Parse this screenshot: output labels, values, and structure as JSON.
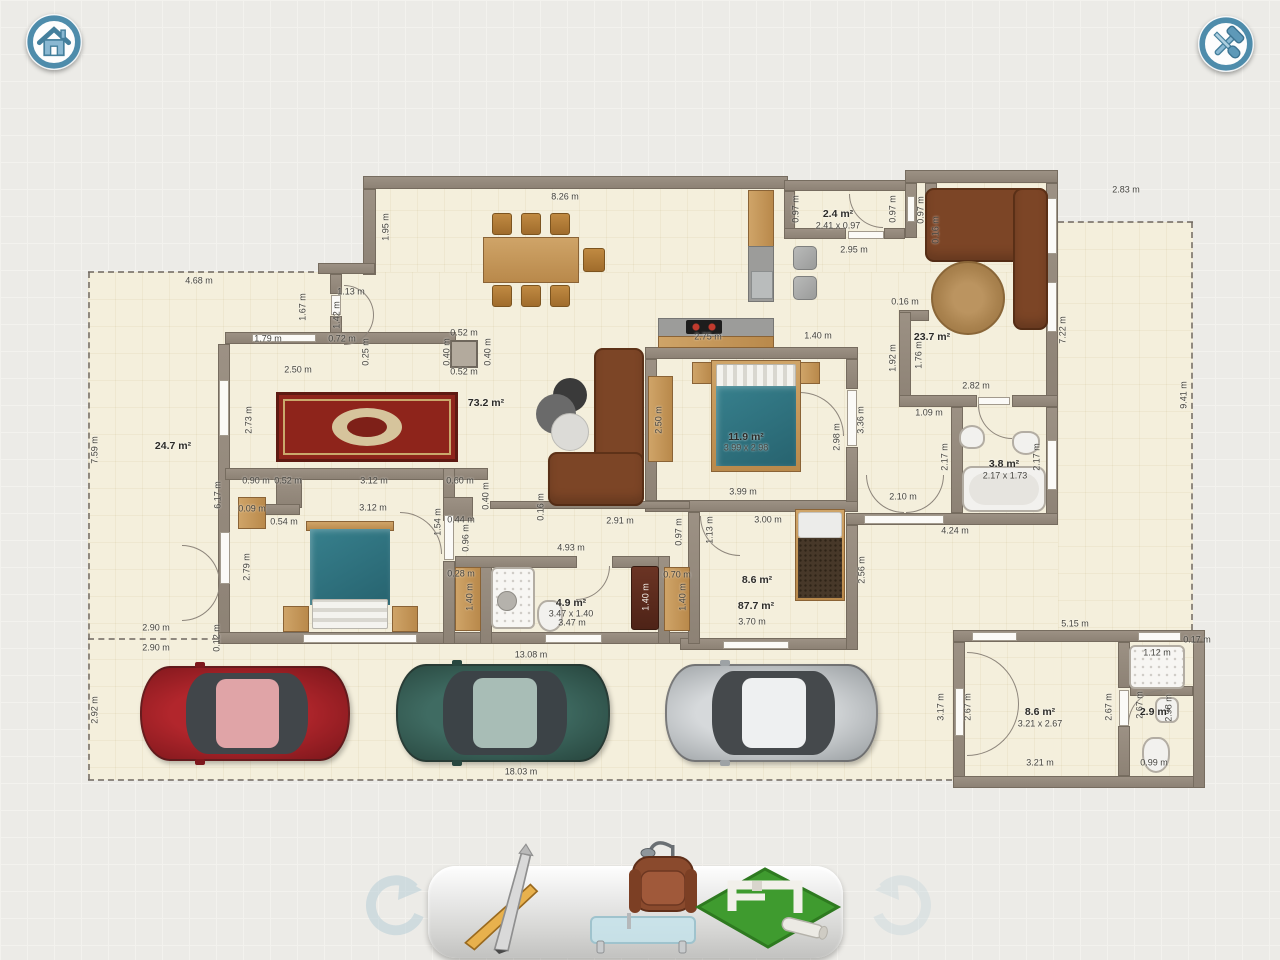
{
  "app": {
    "name": "floor-plan-editor",
    "view": "2d-plan"
  },
  "header": {
    "home_button": {
      "icon": "home-icon"
    },
    "tools_button": {
      "icon": "hammer-screwdriver-icon"
    }
  },
  "tray": {
    "undo_icon": "undo-arrow-icon",
    "redo_icon": "redo-arrow-icon",
    "tools": [
      {
        "name": "draw-tool",
        "icon": "pencil-ruler-icon"
      },
      {
        "name": "furnish-tool",
        "icon": "armchair-lamp-table-icon"
      },
      {
        "name": "build-tool",
        "icon": "house-model-grass-icon"
      }
    ]
  },
  "colors": {
    "accent_blue": "#4e8cab",
    "wall": "#948a7d",
    "floor": "#f4efdc",
    "bed_teal": "#2f7582",
    "rug_red": "#8e241b",
    "sofa_brown": "#7c4526",
    "car_red": "#b2262c",
    "car_teal": "#3f6b62",
    "car_silver": "#d2d5d7",
    "grass_green": "#3f9b2f"
  },
  "plan": {
    "unit": "m",
    "labels": [
      {
        "t": "8.26 m",
        "x": 565,
        "y": 197
      },
      {
        "t": "1.95 m",
        "x": 386,
        "y": 227,
        "r": 1
      },
      {
        "t": "2.83 m",
        "x": 1126,
        "y": 190
      },
      {
        "t": "7.22 m",
        "x": 1063,
        "y": 330,
        "r": 1
      },
      {
        "t": "9.41 m",
        "x": 1184,
        "y": 395,
        "r": 1
      },
      {
        "t": "4.68 m",
        "x": 199,
        "y": 281
      },
      {
        "t": "1.13 m",
        "x": 351,
        "y": 292
      },
      {
        "t": "1.67 m",
        "x": 303,
        "y": 307,
        "r": 1
      },
      {
        "t": "1.42 m",
        "x": 337,
        "y": 315,
        "r": 1
      },
      {
        "t": "1.79 m",
        "x": 268,
        "y": 339
      },
      {
        "t": "0.72 m",
        "x": 342,
        "y": 339
      },
      {
        "t": "0.25 m",
        "x": 366,
        "y": 352,
        "r": 1
      },
      {
        "t": "2.50 m",
        "x": 298,
        "y": 370
      },
      {
        "t": "0.52 m",
        "x": 464,
        "y": 333
      },
      {
        "t": "0.40 m",
        "x": 447,
        "y": 352,
        "r": 1
      },
      {
        "t": "0.40 m",
        "x": 488,
        "y": 352,
        "r": 1
      },
      {
        "t": "0.52 m",
        "x": 464,
        "y": 372
      },
      {
        "t": "73.2 m²",
        "x": 486,
        "y": 403,
        "b": 1
      },
      {
        "t": "24.7 m²",
        "x": 173,
        "y": 446,
        "b": 1
      },
      {
        "t": "7.59 m",
        "x": 95,
        "y": 450,
        "r": 1
      },
      {
        "t": "2.73 m",
        "x": 249,
        "y": 420,
        "r": 1
      },
      {
        "t": "2.4 m²",
        "x": 838,
        "y": 214,
        "b": 1
      },
      {
        "t": "2.41 x 0.97",
        "x": 838,
        "y": 226
      },
      {
        "t": "0.97 m",
        "x": 796,
        "y": 209,
        "r": 1
      },
      {
        "t": "0.97 m",
        "x": 893,
        "y": 209,
        "r": 1
      },
      {
        "t": "0.97 m",
        "x": 921,
        "y": 210,
        "r": 1
      },
      {
        "t": "0.16 m",
        "x": 936,
        "y": 230,
        "r": 1
      },
      {
        "t": "2.95 m",
        "x": 854,
        "y": 250
      },
      {
        "t": "2.75 m",
        "x": 708,
        "y": 337
      },
      {
        "t": "1.40 m",
        "x": 818,
        "y": 336
      },
      {
        "t": "0.16 m",
        "x": 905,
        "y": 302
      },
      {
        "t": "23.7 m²",
        "x": 932,
        "y": 337,
        "b": 1
      },
      {
        "t": "1.92 m",
        "x": 893,
        "y": 358,
        "r": 1
      },
      {
        "t": "1.76 m",
        "x": 919,
        "y": 355,
        "r": 1
      },
      {
        "t": "2.82 m",
        "x": 976,
        "y": 386
      },
      {
        "t": "1.09 m",
        "x": 929,
        "y": 413
      },
      {
        "t": "3.8 m²",
        "x": 1004,
        "y": 464,
        "b": 1
      },
      {
        "t": "2.17 x 1.73",
        "x": 1005,
        "y": 476
      },
      {
        "t": "2.17 m",
        "x": 945,
        "y": 457,
        "r": 1
      },
      {
        "t": "2.17 m",
        "x": 1037,
        "y": 457,
        "r": 1
      },
      {
        "t": "2.10 m",
        "x": 903,
        "y": 497
      },
      {
        "t": "4.24 m",
        "x": 955,
        "y": 531
      },
      {
        "t": "2.50 m",
        "x": 659,
        "y": 420,
        "r": 1
      },
      {
        "t": "11.9 m²",
        "x": 746,
        "y": 437,
        "b": 1
      },
      {
        "t": "3.99 x 2.98",
        "x": 746,
        "y": 448
      },
      {
        "t": "2.98 m",
        "x": 837,
        "y": 437,
        "r": 1
      },
      {
        "t": "3.36 m",
        "x": 861,
        "y": 420,
        "r": 1
      },
      {
        "t": "3.99 m",
        "x": 743,
        "y": 492
      },
      {
        "t": "0.90 m",
        "x": 256,
        "y": 481
      },
      {
        "t": "0.52 m",
        "x": 288,
        "y": 481
      },
      {
        "t": "3.12 m",
        "x": 374,
        "y": 481
      },
      {
        "t": "0.60 m",
        "x": 460,
        "y": 481
      },
      {
        "t": "0.40 m",
        "x": 486,
        "y": 496,
        "r": 1
      },
      {
        "t": "6.17 m",
        "x": 218,
        "y": 495,
        "r": 1
      },
      {
        "t": "0.09 m",
        "x": 252,
        "y": 509
      },
      {
        "t": "3.12 m",
        "x": 373,
        "y": 508
      },
      {
        "t": "0.54 m",
        "x": 284,
        "y": 522
      },
      {
        "t": "0.44 m",
        "x": 461,
        "y": 520
      },
      {
        "t": "1.54 m",
        "x": 438,
        "y": 522,
        "r": 1
      },
      {
        "t": "0.96 m",
        "x": 466,
        "y": 538,
        "r": 1
      },
      {
        "t": "2.79 m",
        "x": 247,
        "y": 567,
        "r": 1
      },
      {
        "t": "0.16 m",
        "x": 541,
        "y": 507,
        "r": 1
      },
      {
        "t": "2.91 m",
        "x": 620,
        "y": 521
      },
      {
        "t": "4.93 m",
        "x": 571,
        "y": 548
      },
      {
        "t": "0.97 m",
        "x": 679,
        "y": 532,
        "r": 1
      },
      {
        "t": "1.13 m",
        "x": 710,
        "y": 530,
        "r": 1
      },
      {
        "t": "3.00 m",
        "x": 768,
        "y": 520
      },
      {
        "t": "8.6 m²",
        "x": 757,
        "y": 580,
        "b": 1
      },
      {
        "t": "87.7 m²",
        "x": 756,
        "y": 606,
        "b": 1
      },
      {
        "t": "3.70 m",
        "x": 752,
        "y": 622
      },
      {
        "t": "2.56 m",
        "x": 862,
        "y": 570,
        "r": 1
      },
      {
        "t": "0.28 m",
        "x": 461,
        "y": 574
      },
      {
        "t": "1.40 m",
        "x": 470,
        "y": 597,
        "r": 1
      },
      {
        "t": "4.9 m²",
        "x": 571,
        "y": 603,
        "b": 1
      },
      {
        "t": "3.47 x 1.40",
        "x": 571,
        "y": 614
      },
      {
        "t": "3.47 m",
        "x": 572,
        "y": 623
      },
      {
        "t": "1.40 m",
        "x": 646,
        "y": 597,
        "r": 1,
        "w": 1
      },
      {
        "t": "0.70 m",
        "x": 677,
        "y": 575
      },
      {
        "t": "1.40 m",
        "x": 683,
        "y": 597,
        "r": 1
      },
      {
        "t": "13.08 m",
        "x": 531,
        "y": 655
      },
      {
        "t": "2.90 m",
        "x": 156,
        "y": 628
      },
      {
        "t": "2.90 m",
        "x": 156,
        "y": 648
      },
      {
        "t": "0.12 m",
        "x": 217,
        "y": 638,
        "r": 1
      },
      {
        "t": "2.92 m",
        "x": 95,
        "y": 710,
        "r": 1
      },
      {
        "t": "18.03 m",
        "x": 521,
        "y": 772
      },
      {
        "t": "5.15 m",
        "x": 1075,
        "y": 624
      },
      {
        "t": "0.17 m",
        "x": 1197,
        "y": 640
      },
      {
        "t": "3.17 m",
        "x": 941,
        "y": 707,
        "r": 1
      },
      {
        "t": "2.67 m",
        "x": 968,
        "y": 707,
        "r": 1
      },
      {
        "t": "8.6 m²",
        "x": 1040,
        "y": 712,
        "b": 1
      },
      {
        "t": "3.21 x 2.67",
        "x": 1040,
        "y": 724
      },
      {
        "t": "2.67 m",
        "x": 1109,
        "y": 707,
        "r": 1
      },
      {
        "t": "3.21 m",
        "x": 1040,
        "y": 763
      },
      {
        "t": "1.12 m",
        "x": 1157,
        "y": 653
      },
      {
        "t": "2.67 m",
        "x": 1140,
        "y": 705,
        "r": 1
      },
      {
        "t": "2.98 m",
        "x": 1169,
        "y": 708,
        "r": 1
      },
      {
        "t": "2.9 m²",
        "x": 1155,
        "y": 712,
        "b": 1
      },
      {
        "t": "0.99 m",
        "x": 1154,
        "y": 763
      }
    ],
    "walls": [
      [
        363,
        176,
        425,
        13
      ],
      [
        784,
        180,
        126,
        11
      ],
      [
        905,
        170,
        153,
        13
      ],
      [
        1046,
        183,
        12,
        224
      ],
      [
        1046,
        407,
        12,
        118
      ],
      [
        363,
        189,
        13,
        86
      ],
      [
        318,
        263,
        57,
        11
      ],
      [
        330,
        274,
        12,
        20
      ],
      [
        330,
        316,
        12,
        28
      ],
      [
        225,
        332,
        231,
        12
      ],
      [
        218,
        344,
        12,
        300
      ],
      [
        218,
        632,
        474,
        12
      ],
      [
        680,
        638,
        178,
        12
      ],
      [
        846,
        525,
        12,
        125
      ],
      [
        846,
        513,
        212,
        12
      ],
      [
        645,
        347,
        213,
        12
      ],
      [
        645,
        359,
        12,
        153
      ],
      [
        645,
        500,
        213,
        12
      ],
      [
        846,
        359,
        12,
        30
      ],
      [
        846,
        447,
        12,
        55
      ],
      [
        905,
        183,
        12,
        55
      ],
      [
        925,
        183,
        12,
        55
      ],
      [
        784,
        191,
        11,
        45
      ],
      [
        784,
        228,
        62,
        11
      ],
      [
        884,
        228,
        21,
        11
      ],
      [
        899,
        310,
        30,
        11
      ],
      [
        899,
        312,
        12,
        94
      ],
      [
        899,
        395,
        78,
        12
      ],
      [
        1012,
        395,
        46,
        12
      ],
      [
        951,
        407,
        12,
        106
      ],
      [
        225,
        468,
        263,
        12
      ],
      [
        276,
        478,
        26,
        30
      ],
      [
        264,
        504,
        36,
        11
      ],
      [
        443,
        468,
        12,
        46
      ],
      [
        443,
        561,
        12,
        83
      ],
      [
        443,
        497,
        30,
        24
      ],
      [
        490,
        501,
        200,
        8
      ],
      [
        480,
        558,
        12,
        86
      ],
      [
        455,
        556,
        122,
        12
      ],
      [
        612,
        556,
        57,
        12
      ],
      [
        658,
        556,
        12,
        88
      ],
      [
        688,
        512,
        12,
        132
      ],
      [
        953,
        630,
        252,
        12
      ],
      [
        953,
        642,
        12,
        146
      ],
      [
        953,
        776,
        252,
        12
      ],
      [
        1193,
        642,
        12,
        146
      ],
      [
        1118,
        642,
        12,
        46
      ],
      [
        1118,
        726,
        12,
        50
      ],
      [
        1130,
        686,
        63,
        10
      ]
    ],
    "windows": [
      [
        1047,
        198,
        10,
        56
      ],
      [
        1047,
        282,
        10,
        50
      ],
      [
        1047,
        440,
        10,
        50
      ],
      [
        907,
        196,
        8,
        26
      ],
      [
        219,
        380,
        10,
        56
      ],
      [
        220,
        532,
        10,
        52
      ],
      [
        252,
        334,
        64,
        8
      ],
      [
        303,
        634,
        114,
        9
      ],
      [
        545,
        634,
        57,
        9
      ],
      [
        723,
        641,
        66,
        8
      ],
      [
        848,
        231,
        36,
        8
      ],
      [
        847,
        390,
        10,
        56
      ],
      [
        864,
        515,
        80,
        9
      ],
      [
        978,
        397,
        32,
        8
      ],
      [
        331,
        295,
        10,
        20
      ],
      [
        444,
        515,
        10,
        45
      ],
      [
        972,
        632,
        45,
        9
      ],
      [
        1138,
        632,
        43,
        9
      ],
      [
        955,
        688,
        9,
        48
      ],
      [
        1119,
        690,
        10,
        36
      ]
    ],
    "doors": [
      {
        "x": 344,
        "y": 285,
        "s": 30,
        "c": "tr"
      },
      {
        "x": 344,
        "y": 315,
        "s": 30,
        "c": "br"
      },
      {
        "x": 849,
        "y": 194,
        "s": 34,
        "c": "bl"
      },
      {
        "x": 1014,
        "y": 219,
        "s": 32,
        "c": "tl"
      },
      {
        "x": 800,
        "y": 392,
        "s": 44,
        "c": "tr"
      },
      {
        "x": 978,
        "y": 405,
        "s": 34,
        "c": "bl"
      },
      {
        "x": 866,
        "y": 475,
        "s": 38,
        "c": "bl"
      },
      {
        "x": 906,
        "y": 475,
        "s": 38,
        "c": "br"
      },
      {
        "x": 400,
        "y": 512,
        "s": 42,
        "c": "tr"
      },
      {
        "x": 576,
        "y": 566,
        "s": 34,
        "c": "br"
      },
      {
        "x": 700,
        "y": 516,
        "s": 40,
        "c": "bl"
      },
      {
        "x": 182,
        "y": 545,
        "s": 38,
        "c": "tr"
      },
      {
        "x": 182,
        "y": 583,
        "s": 38,
        "c": "br"
      },
      {
        "x": 967,
        "y": 652,
        "s": 52,
        "c": "tr"
      },
      {
        "x": 967,
        "y": 704,
        "s": 52,
        "c": "br"
      },
      {
        "x": 1128,
        "y": 690,
        "s": 34,
        "c": "tl"
      }
    ]
  }
}
